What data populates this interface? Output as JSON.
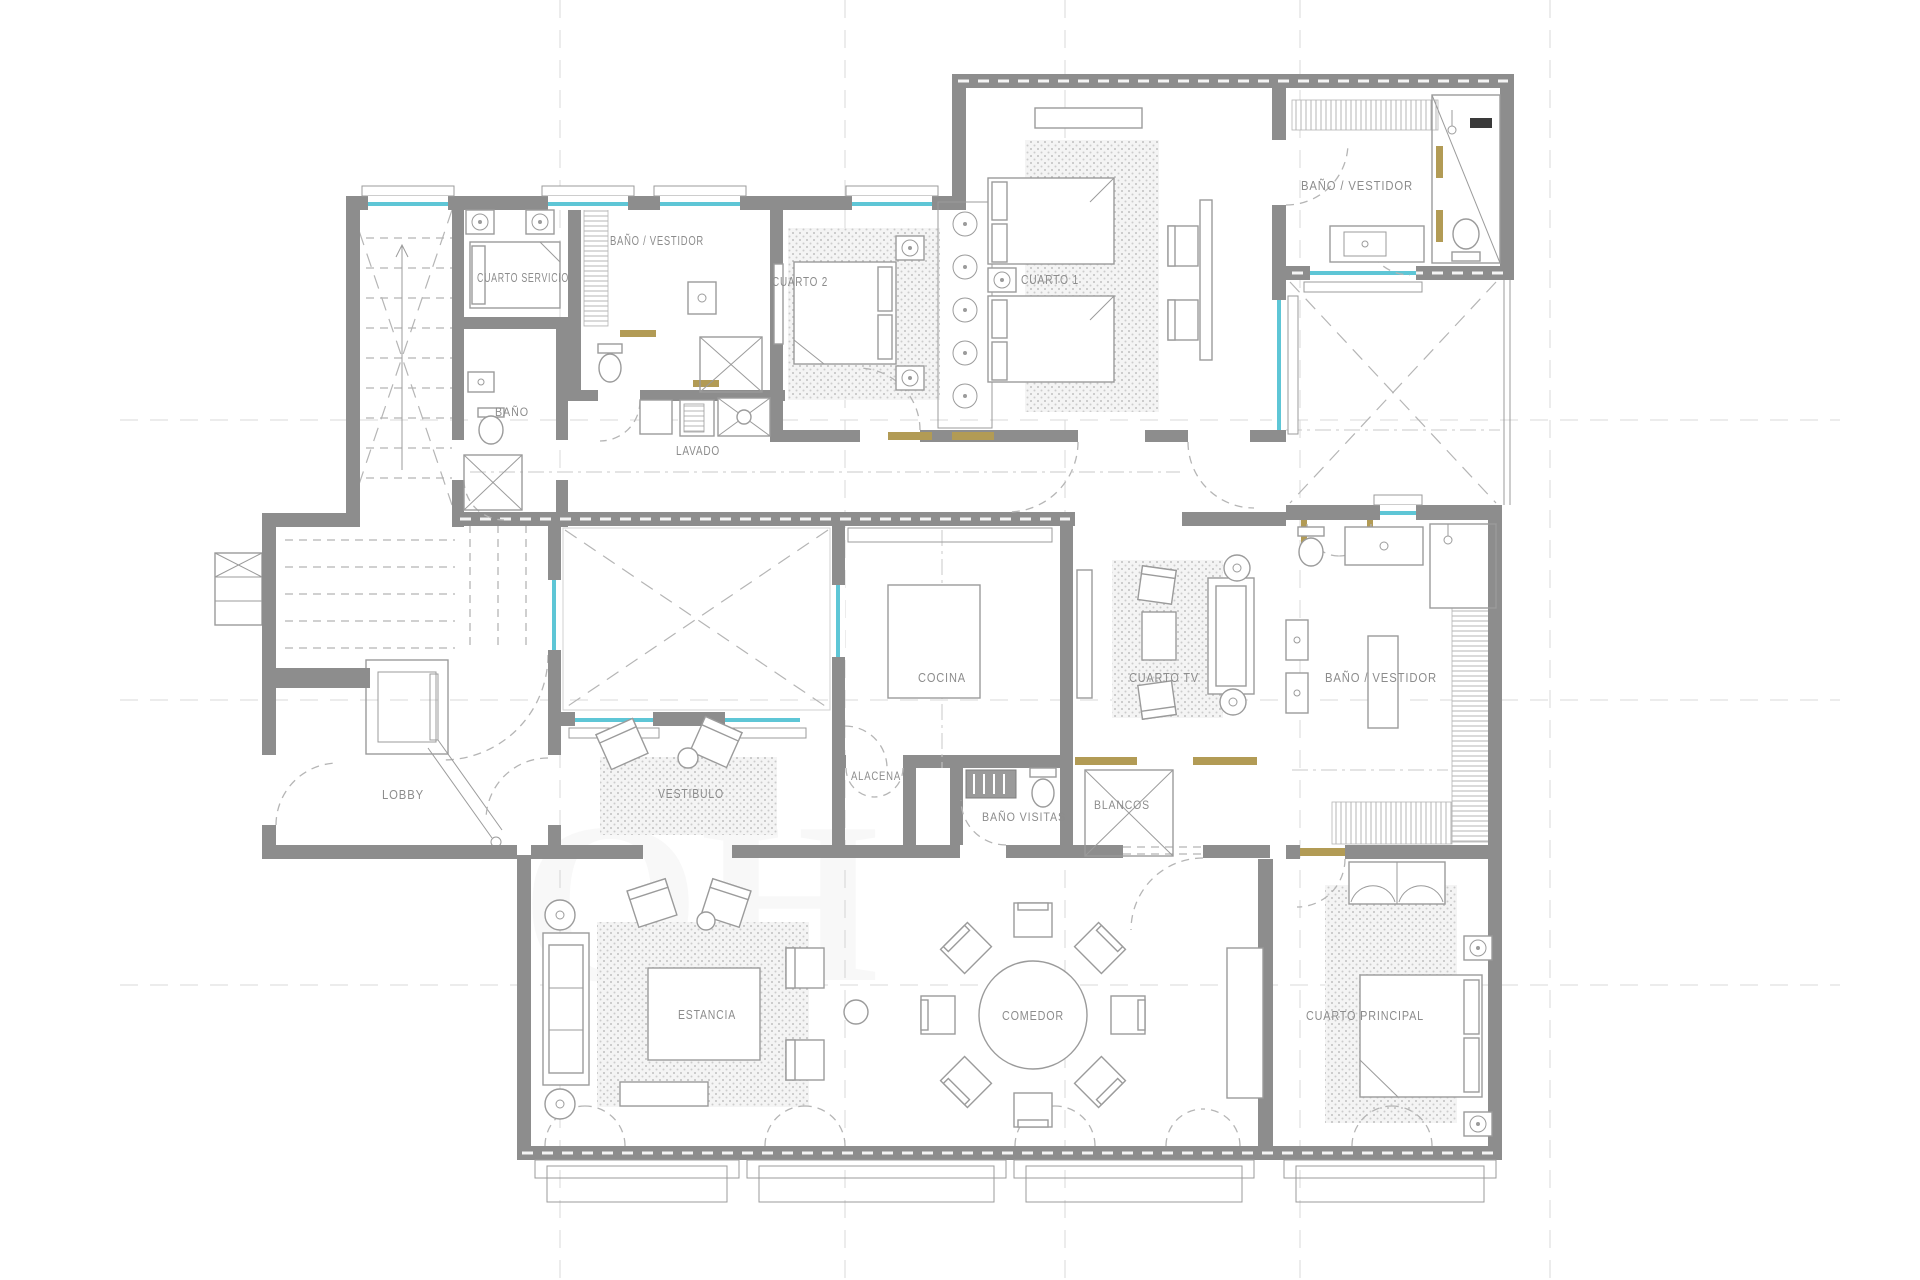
{
  "plan": {
    "name": "apartment-floor-plan",
    "colors": {
      "wall": "#8d8d8d",
      "line": "#9b9b9b",
      "dash": "#b5b5b5",
      "grid": "#d8d8d8",
      "window": "#5ec6d6",
      "wood": "#b29b55",
      "label": "#8c8c8c",
      "rugdot": "#c6c6c6",
      "watermark": "#8a8a8a"
    },
    "labels": [
      {
        "id": "cuarto-servicio",
        "text": "CUARTO  SERVICIO",
        "x": 523,
        "y": 282,
        "w": 92
      },
      {
        "id": "bano-vestidor-top",
        "text": "BAÑO  /  VESTIDOR",
        "x": 657,
        "y": 245,
        "w": 94
      },
      {
        "id": "cuarto-2",
        "text": "CUARTO  2",
        "x": 800,
        "y": 286,
        "w": 56
      },
      {
        "id": "cuarto-1",
        "text": "CUARTO  1",
        "x": 1050,
        "y": 284,
        "w": 58
      },
      {
        "id": "bano-vestidor-top-right",
        "text": "BAÑO  /  VESTIDOR",
        "x": 1357,
        "y": 190,
        "w": 112
      },
      {
        "id": "bano-servicio",
        "text": "BAÑO",
        "x": 512,
        "y": 416,
        "w": 34,
        "size": 12
      },
      {
        "id": "lavado",
        "text": "LAVADO",
        "x": 698,
        "y": 455,
        "w": 44
      },
      {
        "id": "lobby",
        "text": "LOBBY",
        "x": 403,
        "y": 799,
        "w": 42
      },
      {
        "id": "vestibulo",
        "text": "VESTIBULO",
        "x": 691,
        "y": 798,
        "w": 66
      },
      {
        "id": "cocina",
        "text": "COCINA",
        "x": 942,
        "y": 682,
        "w": 48
      },
      {
        "id": "cuarto-tv",
        "text": "CUARTO  TV",
        "x": 1164,
        "y": 682,
        "w": 70
      },
      {
        "id": "bano-vestidor-right",
        "text": "BAÑO  /  VESTIDOR",
        "x": 1381,
        "y": 682,
        "w": 112
      },
      {
        "id": "alacena",
        "text": "ALACENA",
        "x": 876,
        "y": 780,
        "w": 50,
        "size": 12
      },
      {
        "id": "bano-visitas",
        "text": "BAÑO  VISITAS",
        "x": 1024,
        "y": 821,
        "w": 84,
        "size": 12
      },
      {
        "id": "blancos",
        "text": "BLANCOS",
        "x": 1122,
        "y": 809,
        "w": 56,
        "size": 12
      },
      {
        "id": "estancia",
        "text": "ESTANCIA",
        "x": 707,
        "y": 1019,
        "w": 58
      },
      {
        "id": "comedor",
        "text": "COMEDOR",
        "x": 1033,
        "y": 1020,
        "w": 62
      },
      {
        "id": "cuarto-principal",
        "text": "CUARTO  PRINCIPAL",
        "x": 1365,
        "y": 1020,
        "w": 118
      }
    ],
    "watermark": {
      "line1": "OH",
      "line2": "UR"
    }
  }
}
